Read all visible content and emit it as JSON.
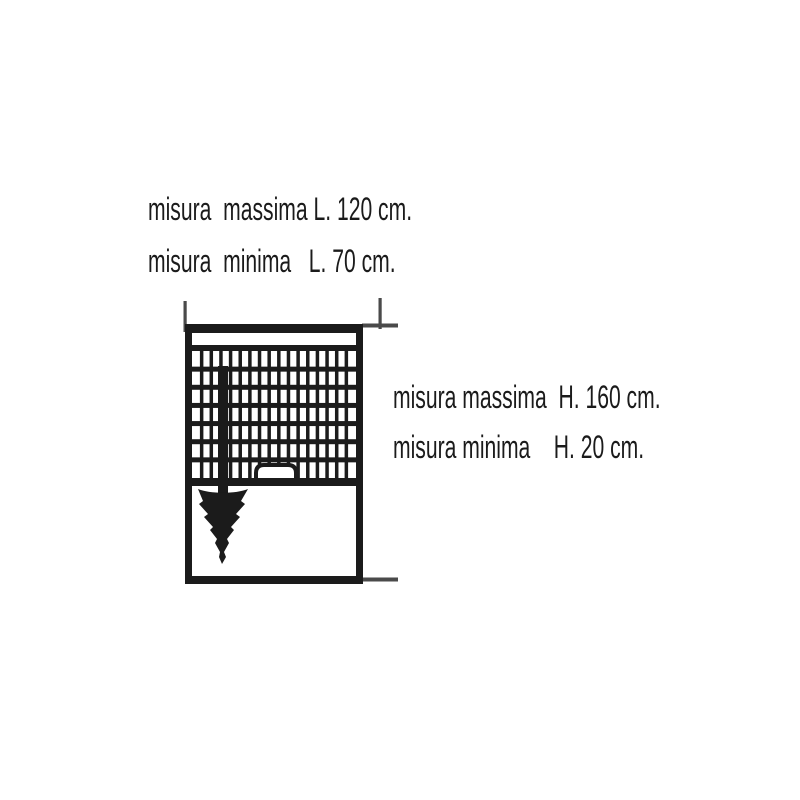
{
  "page": {
    "background_color": "#ffffff",
    "ink_color": "#1b1b1b",
    "tick_color": "#4a4a4a"
  },
  "annotations": {
    "width": {
      "max_label": "misura  massima L. 120 cm.",
      "min_label": "misura  minima   L. 70 cm."
    },
    "height": {
      "max_label": "misura massima  H. 160 cm.",
      "min_label": "misura minima    H. 20 cm."
    }
  },
  "measurements": {
    "unit": "cm",
    "width_max": 120,
    "width_min": 70,
    "height_max": 160,
    "height_min": 20
  },
  "diagram": {
    "kind": "roller-blind-front-view",
    "grid_columns": 17,
    "grid_rows": 7,
    "grid_x": 192,
    "grid_y": 351,
    "grid_width": 164,
    "grid_height": 127
  }
}
